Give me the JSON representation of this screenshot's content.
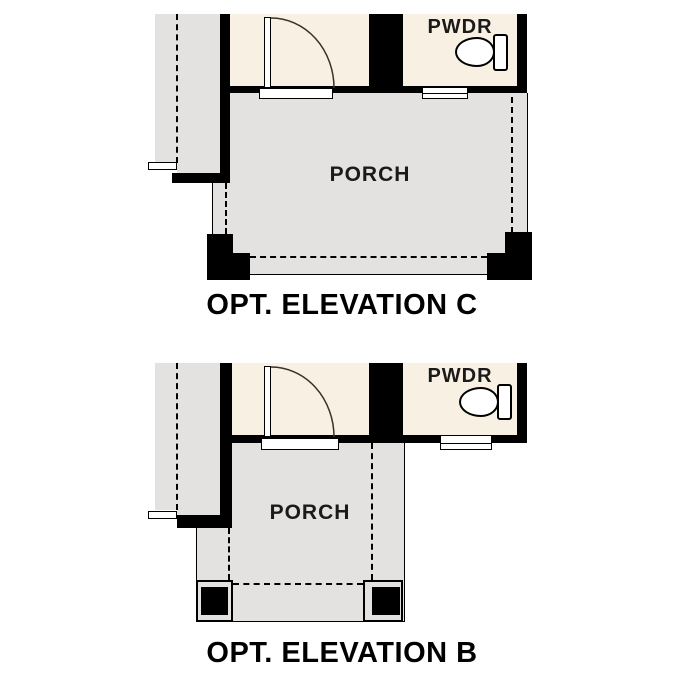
{
  "canvas": {
    "width": 687,
    "height": 687,
    "background": "#ffffff"
  },
  "colors": {
    "wall": "#000000",
    "interior_cream": "#f8f0e3",
    "porch_gray": "#e3e2e0",
    "line": "#000000",
    "background": "#ffffff"
  },
  "icons": {
    "toilet": "toilet-icon (bowl ellipse + tank, css shapes)",
    "door_swing": "door-swing-arc (quarter-circle svg stroke)",
    "window": "window-symbol (white double rect in wall)"
  },
  "plans": [
    {
      "id": "elevation-c",
      "title": "OPT. ELEVATION C",
      "porch_label": "PORCH",
      "pwdr_label": "PWDR"
    },
    {
      "id": "elevation-b",
      "title": "OPT. ELEVATION B",
      "porch_label": "PORCH",
      "pwdr_label": "PWDR"
    }
  ]
}
